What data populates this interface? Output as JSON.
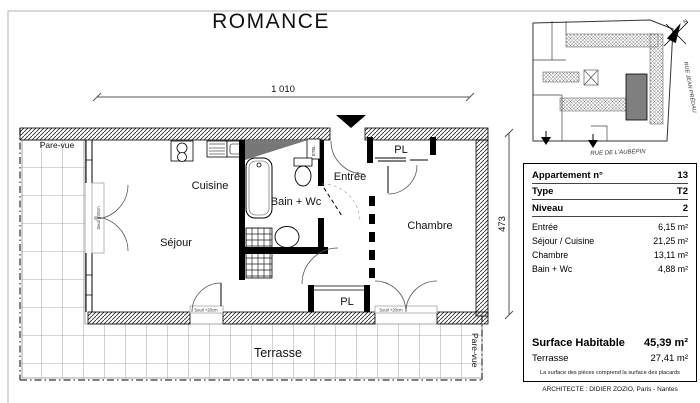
{
  "title": "ROMANCE",
  "plan": {
    "width_dim": "1 010",
    "height_dim": "473",
    "rooms": {
      "sejour": "Séjour",
      "cuisine": "Cuisine",
      "bain_wc": "Bain + Wc",
      "entree": "Entrée",
      "chambre": "Chambre",
      "pl_top": "PL",
      "pl_bottom": "PL",
      "terrasse": "Terrasse"
    },
    "annotations": {
      "pare_vue_left": "Pare-vue",
      "pare_vue_right": "Pare-vue",
      "seuil": "Seuil +20cm",
      "etel": "ETEL"
    }
  },
  "site_map": {
    "north_label": "N",
    "street_right": "RUE JEAN PRÉDAU",
    "street_bottom": "RUE DE L'AUBÉPIN"
  },
  "table": {
    "header_rows": [
      {
        "label": "Appartement n°",
        "value": "13"
      },
      {
        "label": "Type",
        "value": "T2"
      },
      {
        "label": "Niveau",
        "value": "2"
      }
    ],
    "area_rows": [
      {
        "label": "Entrée",
        "value": "6,15 m²"
      },
      {
        "label": "Séjour / Cuisine",
        "value": "21,25 m²"
      },
      {
        "label": "Chambre",
        "value": "13,11 m²"
      },
      {
        "label": "Bain + Wc",
        "value": "4,88 m²"
      }
    ],
    "summary_rows": [
      {
        "label": "Surface Habitable",
        "value": "45,39 m²"
      },
      {
        "label": "Terrasse",
        "value": "27,41 m²"
      }
    ],
    "note": "La surface des pièces comprend la surface des placards"
  },
  "footer": {
    "architect": "ARCHITECTE : DIDIER ZOZIO, Paris - Nantes"
  },
  "colors": {
    "map_unit_fill": "#7f7f7f",
    "wall_wedge": "#777777"
  }
}
